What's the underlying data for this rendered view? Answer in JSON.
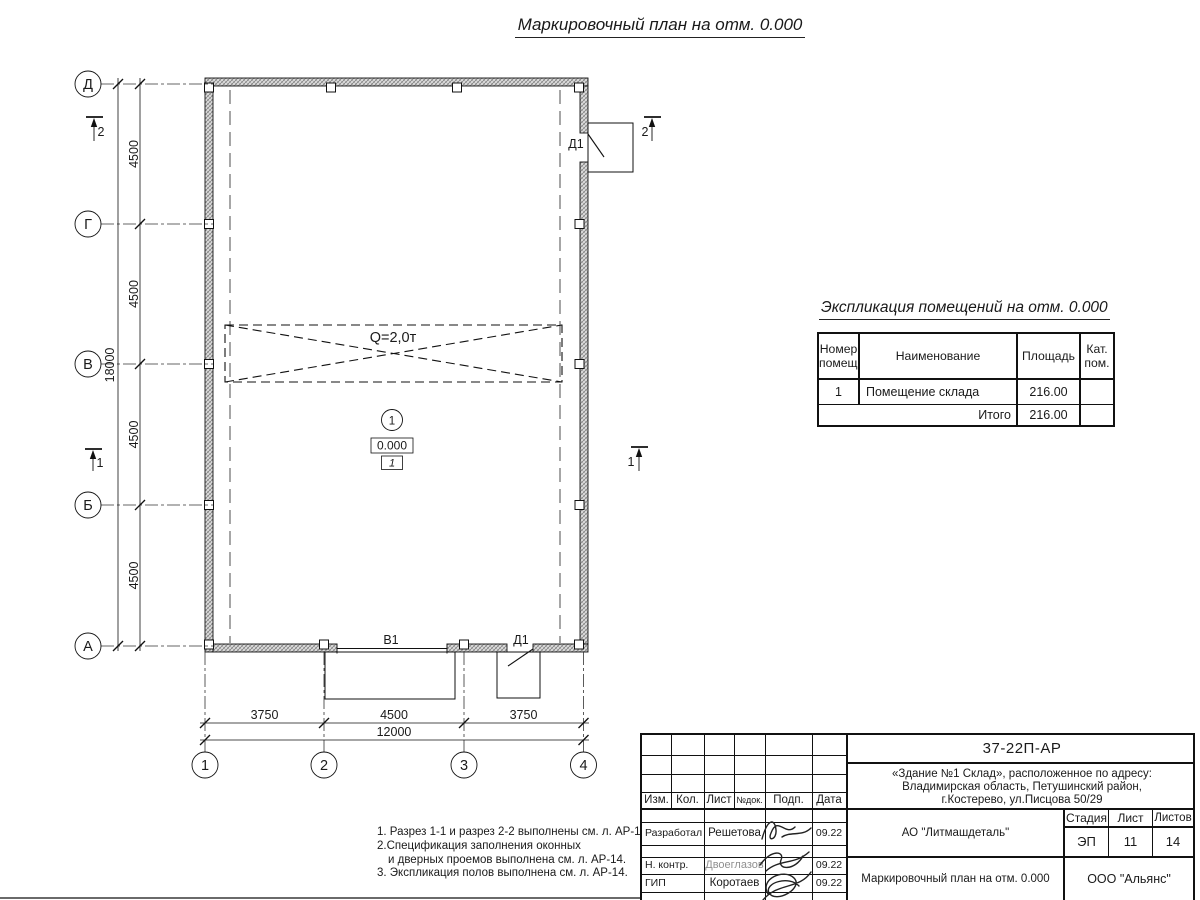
{
  "sheet": {
    "plan_title": "Маркировочный план на отм. 0.000"
  },
  "plan": {
    "row_axes": [
      "Д",
      "Г",
      "В",
      "Б",
      "А"
    ],
    "col_axes": [
      "1",
      "2",
      "3",
      "4"
    ],
    "dims": {
      "left_segments": [
        "4500",
        "4500",
        "4500",
        "4500"
      ],
      "left_total": "18000",
      "bottom_segments": [
        "3750",
        "4500",
        "3750"
      ],
      "bottom_total": "12000"
    },
    "crane_label": "Q=2,0т",
    "room": {
      "number": "1",
      "elevation": "0.000",
      "floor_tag": "1"
    },
    "doors": {
      "top_door": "Д1",
      "gate": "В1",
      "bottom_door": "Д1"
    },
    "sections": {
      "s1": "1",
      "s2": "2"
    }
  },
  "explication": {
    "title": "Экспликация помещений на отм. 0.000",
    "col_headers": [
      "Номер помещ.",
      "Наименование",
      "Площадь",
      "Кат. пом."
    ],
    "rows": [
      {
        "number": "1",
        "name": "Помещение склада",
        "area": "216.00",
        "category": ""
      }
    ],
    "total_label": "Итого",
    "total_area": "216.00"
  },
  "notes": {
    "lines": [
      "1. Разрез 1-1 и разрез 2-2 выполнены см. л. АР-13.",
      "2.Спецификация заполнения оконных",
      "и дверных проемов выполнена см. л. АР-14.",
      "3. Экспликация полов выполнена см. л. АР-14."
    ]
  },
  "titleblock": {
    "doc_number": "37-22П-АР",
    "address_lines": [
      "«Здание №1 Склад», расположенное по адресу:",
      "Владимирская область, Петушинский район,",
      "г.Костерево, ул.Писцова 50/29"
    ],
    "header_cols": [
      "Изм.",
      "Кол.",
      "Лист",
      "№док.",
      "Подп.",
      "Дата"
    ],
    "signature_rows": [
      {
        "role": "Разработал",
        "name": "Решетова",
        "date": "09.22"
      },
      {
        "role": "Н. контр.",
        "name": "Двоеглазов",
        "date": "09.22"
      },
      {
        "role": "ГИП",
        "name": "Коротаев",
        "date": "09.22"
      }
    ],
    "organization": "АО \"Литмашдеталь\"",
    "sheet_name": "Маркировочный план на отм. 0.000",
    "company": "ООО \"Альянс\"",
    "stage_header": "Стадия",
    "sheet_header": "Лист",
    "sheets_header": "Листов",
    "stage": "ЭП",
    "sheet_no": "11",
    "sheets_total": "14"
  }
}
